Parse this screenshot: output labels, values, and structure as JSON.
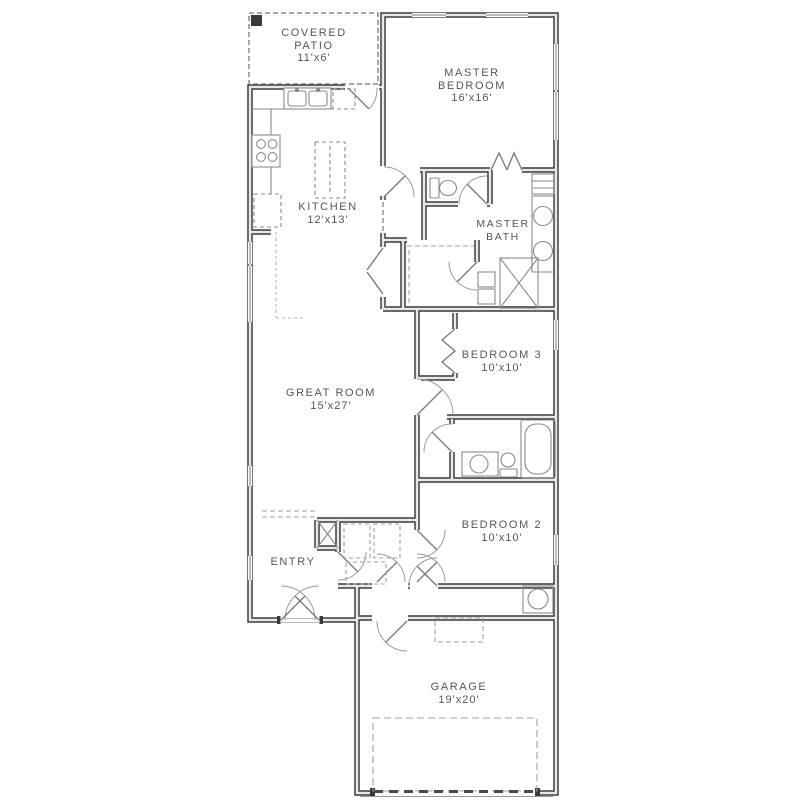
{
  "plan": {
    "type": "single-story house floor plan",
    "colors": {
      "wall": "#3a3a3a",
      "wall_core": "#e8e8e8",
      "text": "#565656",
      "fixture": "#8a8a8a",
      "dash": "#a0a0a0"
    }
  },
  "rooms": {
    "covered_patio": {
      "line1": "COVERED",
      "line2": "PATIO",
      "dims": "11'x6'"
    },
    "master_bedroom": {
      "line1": "MASTER",
      "line2": "BEDROOM",
      "dims": "16'x16'"
    },
    "kitchen": {
      "line1": "KITCHEN",
      "dims": "12'x13'"
    },
    "master_bath": {
      "line1": "MASTER",
      "line2": "BATH"
    },
    "great_room": {
      "line1": "GREAT ROOM",
      "dims": "15'x27'"
    },
    "bedroom_3": {
      "line1": "BEDROOM 3",
      "dims": "10'x10'"
    },
    "bedroom_2": {
      "line1": "BEDROOM 2",
      "dims": "10'x10'"
    },
    "entry": {
      "line1": "ENTRY"
    },
    "garage": {
      "line1": "GARAGE",
      "dims": "19'x20'"
    }
  }
}
